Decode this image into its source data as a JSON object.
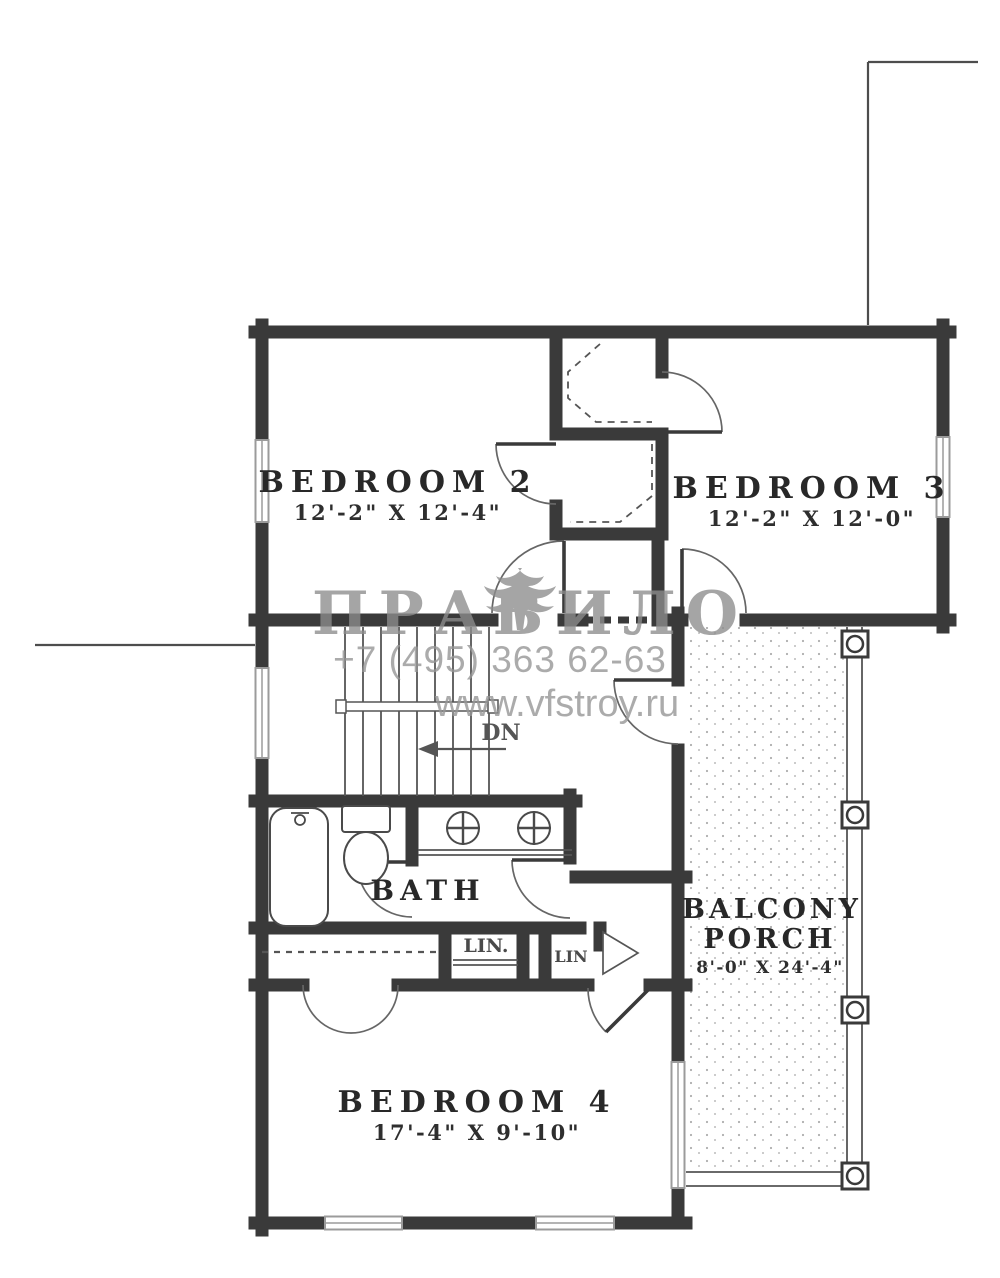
{
  "plan": {
    "bedroom2": {
      "name": "BEDROOM 2",
      "dims": "12'-2\" X 12'-4\""
    },
    "bedroom3": {
      "name": "BEDROOM 3",
      "dims": "12'-2\" X 12'-0\""
    },
    "bedroom4": {
      "name": "BEDROOM 4",
      "dims": "17'-4\" X 9'-10\""
    },
    "bath": {
      "name": "BATH"
    },
    "balcony": {
      "line1": "BALCONY",
      "line2": "PORCH",
      "dims": "8'-0\" X 24'-4\""
    },
    "linen1": {
      "name": "LIN."
    },
    "linen2": {
      "name": "LIN"
    },
    "stairs": {
      "direction": "DN"
    }
  },
  "watermark": {
    "logo_left": "ПРАВ",
    "logo_right": "ИЛО",
    "phone": "+7 (495) 363 62-63",
    "website": "www.vfstroy.ru"
  },
  "colors": {
    "wall": "#3a3a3a",
    "line": "#555555",
    "window": "#9b9b9b",
    "label": "#282828",
    "watermark": "#979797"
  }
}
